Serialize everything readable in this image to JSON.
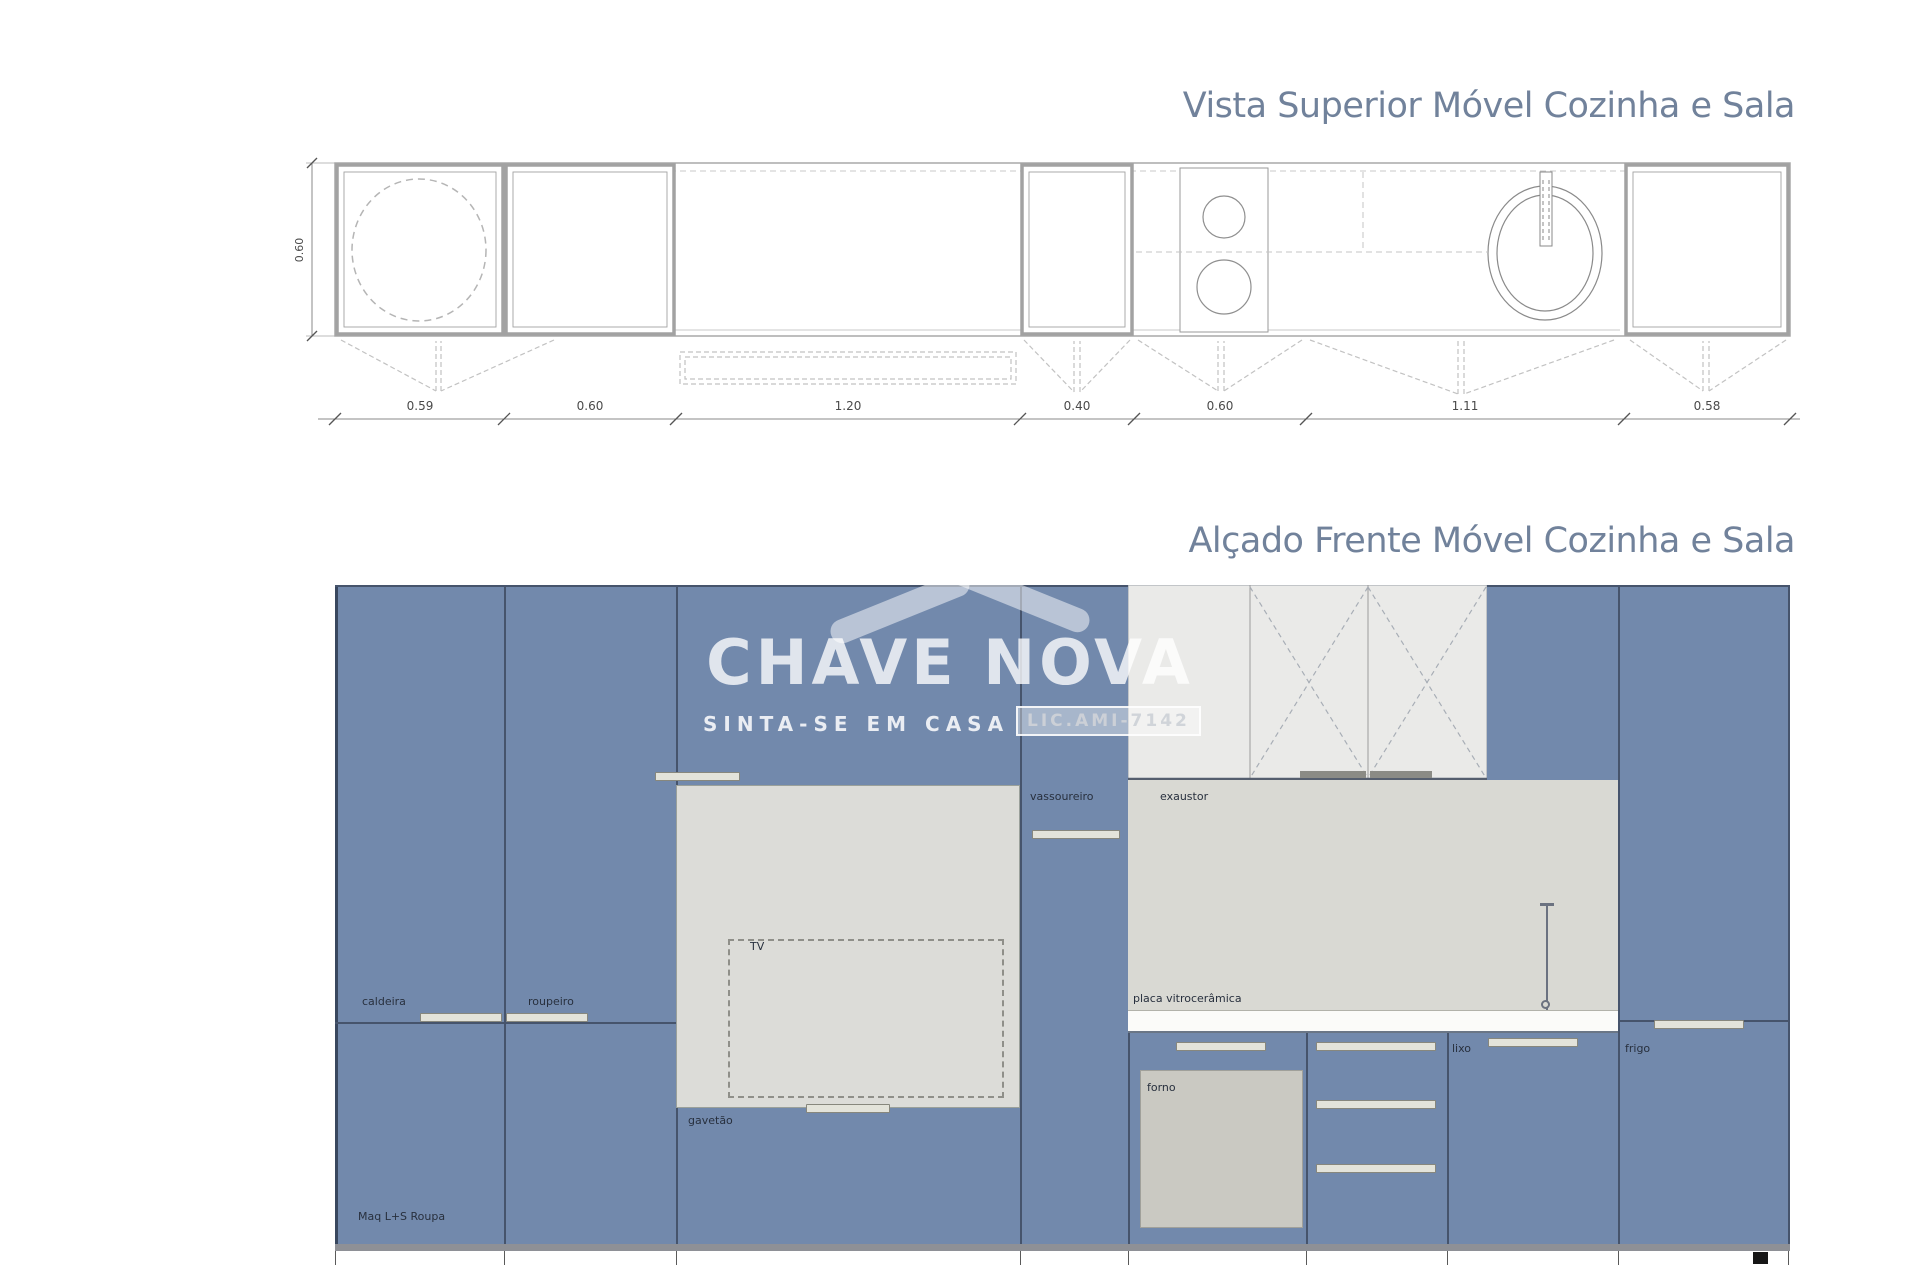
{
  "top_view": {
    "title": "Vista Superior Móvel Cozinha e Sala",
    "height_dim": "0.60",
    "dims": [
      "0.59",
      "0.60",
      "1.20",
      "0.40",
      "0.60",
      "1.11",
      "0.58"
    ]
  },
  "elevation": {
    "title": "Alçado Frente Móvel Cozinha e Sala",
    "labels": {
      "caldeira": "caldeira",
      "roupeiro": "roupeiro",
      "tv": "TV",
      "gavetao": "gavetão",
      "maq": "Maq L+S Roupa",
      "vassoureiro": "vassoureiro",
      "exaustor": "exaustor",
      "placa": "placa vitrocerâmica",
      "forno": "forno",
      "lixo": "lixo",
      "frigo": "frigo"
    }
  },
  "watermark": {
    "brand": "CHAVE NOVA",
    "tagline": "SINTA-SE EM CASA",
    "license": "LIC.AMI-7142"
  },
  "colors": {
    "cabinet-blue": "#7289ac",
    "divider": "#46546c",
    "title-text": "#71829b",
    "upper-gray": "#eaeae8",
    "backsplash-gray": "#d9d9d3",
    "panel-gray": "#dcdcd8",
    "forno-gray": "#cac9c2",
    "handle-light": "#e3e3da"
  }
}
